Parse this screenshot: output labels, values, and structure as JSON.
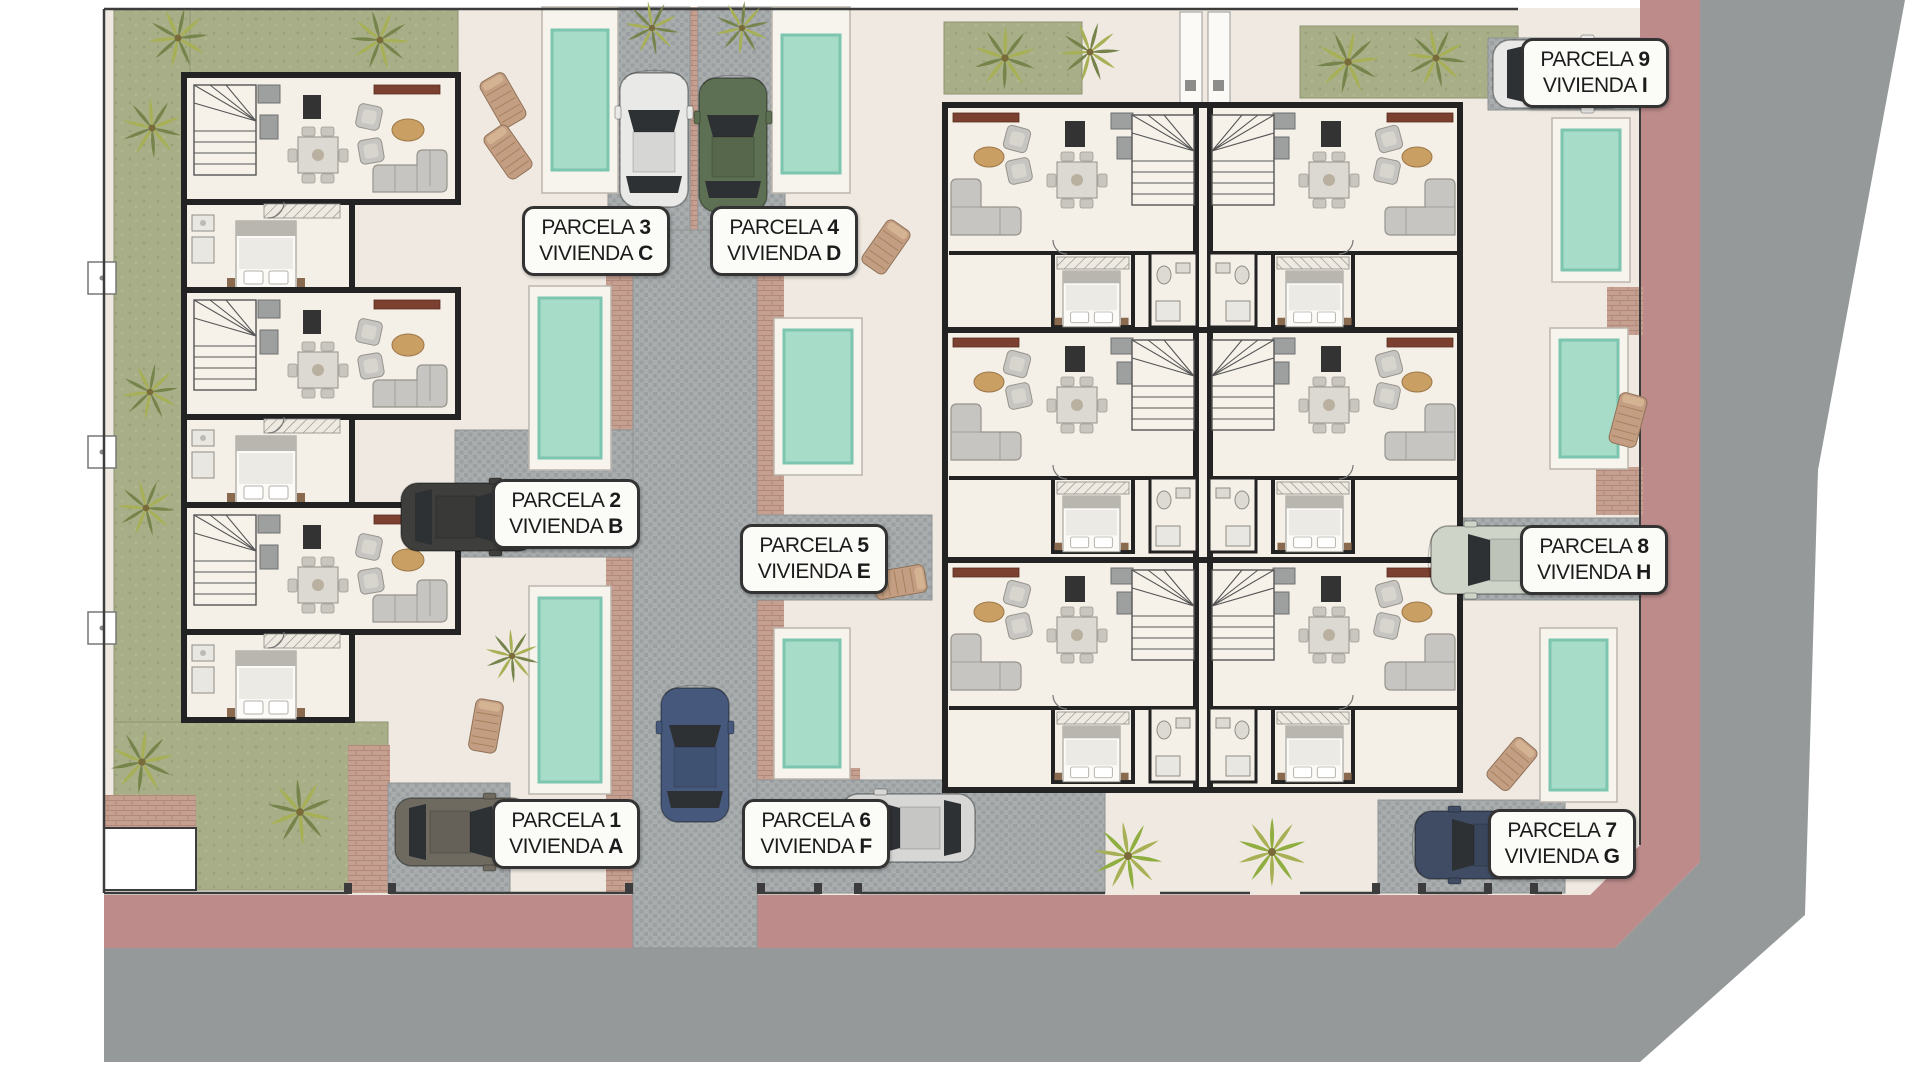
{
  "words": {
    "parcela": "PARCELA",
    "vivienda": "VIVIENDA"
  },
  "labels": [
    {
      "num": "1",
      "letter": "A"
    },
    {
      "num": "2",
      "letter": "B"
    },
    {
      "num": "3",
      "letter": "C"
    },
    {
      "num": "4",
      "letter": "D"
    },
    {
      "num": "5",
      "letter": "E"
    },
    {
      "num": "6",
      "letter": "F"
    },
    {
      "num": "7",
      "letter": "G"
    },
    {
      "num": "8",
      "letter": "H"
    },
    {
      "num": "9",
      "letter": "I"
    }
  ],
  "palette": {
    "ground": "#efe9e1",
    "unit_floor": "#f4efe7",
    "grass": "#a8ae87",
    "road_pink": "#bc8b8a",
    "street_gray": "#95999a",
    "cobble": "#a9adae",
    "cobble_dark": "#9aa0a1",
    "brick": "#c59f90",
    "brick_line": "#b2887a",
    "pool": "#a7dcc8",
    "pool_border": "#7cc5ae",
    "deck": "#f7f4ee",
    "wall": "#232323",
    "furniture": "#c6c5c1",
    "furniture_line": "#97948d",
    "table": "#dcd9d3",
    "appliance": "#333333",
    "sideboard": "#7c4030",
    "lounger": "#c49e82",
    "label_bg": "#fbfbf8",
    "label_border": "#333333",
    "label_text": "#1b1b1b",
    "car_white": "#e9e9e7",
    "car_green": "#5e7053",
    "car_blue": "#46597c",
    "car_silver": "#d7d7d5",
    "car_darkblue": "#3f4c63",
    "car_gray": "#6e6a60",
    "car_black": "#3e3e3c",
    "car_lightgreen": "#cfd4c9",
    "palm_dark": "#76844b",
    "palm_light": "#a7b055",
    "palm_bright": "#8fae3f"
  }
}
